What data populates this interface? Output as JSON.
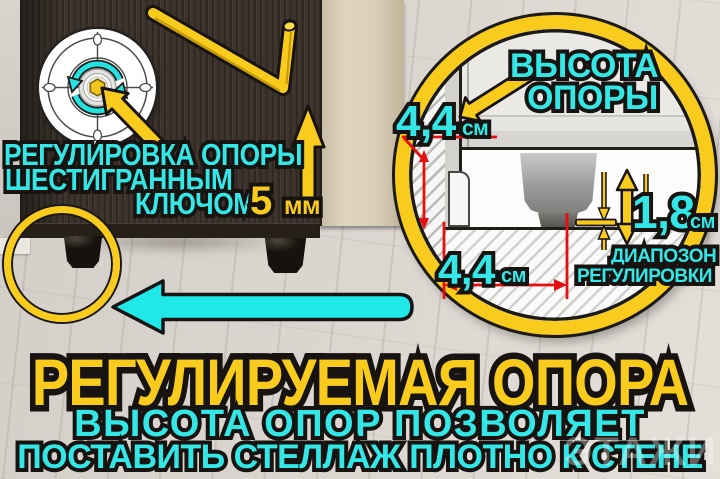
{
  "colors": {
    "accent_yellow": "#f8cb1c",
    "accent_cyan": "#35e6e6",
    "dimension_red": "#e60f0f",
    "outline_black": "#171310"
  },
  "callout_left": {
    "line1": "РЕГУЛИРОВКА ОПОРЫ",
    "line2": "ШЕСТИГРАННЫМ",
    "line3": "КЛЮЧОМ",
    "size_value": "5",
    "size_unit": "мм"
  },
  "inset": {
    "height_label_1": "ВЫСОТА",
    "height_label_2": "ОПОРЫ",
    "dim_side_value": "4,4",
    "dim_side_unit": "см",
    "dim_bottom_value": "4,4",
    "dim_bottom_unit": "см",
    "range_value": "1,8",
    "range_unit": "см",
    "range_label_1": "ДИАПОЗОН",
    "range_label_2": "РЕГУЛИРОВКИ"
  },
  "banner": {
    "title": "РЕГУЛИРУЕМАЯ ОПОРА",
    "subtitle_1": "ВЫСОТА ОПОР ПОЗВОЛЯЕТ",
    "subtitle_2": "ПОСТАВИТЬ СТЕЛЛАЖ ПЛОТНО К СТЕНЕ"
  },
  "watermark": "ЭТАЖИ"
}
